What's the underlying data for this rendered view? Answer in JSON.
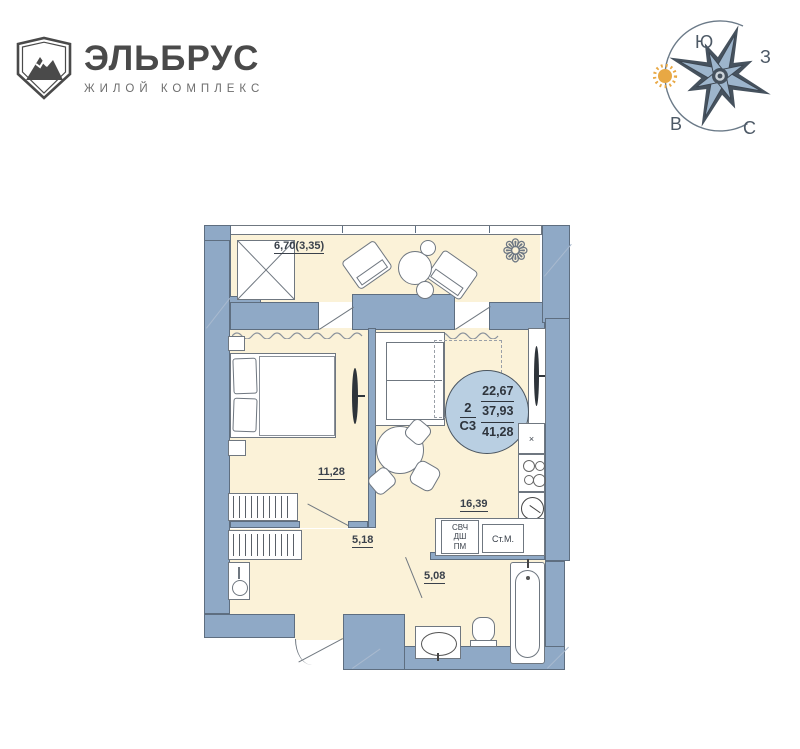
{
  "logo": {
    "name": "ЭЛЬБРУС",
    "tagline": "ЖИЛОЙ КОМПЛЕКС"
  },
  "compass": {
    "south": "Ю",
    "west": "З",
    "east": "В",
    "north": "С"
  },
  "apartment": {
    "badge": {
      "rooms": "2",
      "layout": "С3",
      "living_area": "22,67",
      "floor_area": "37,93",
      "total_area": "41,28"
    },
    "areas": {
      "balcony": "6,70(3,35)",
      "bedroom": "11,28",
      "kitchen_living": "16,39",
      "hallway": "5,18",
      "bathroom": "5,08"
    },
    "appliances": [
      "СВЧ",
      "ДШ",
      "ПМ"
    ],
    "washing_machine": "Ст.М.",
    "cabinet_mark": "×"
  },
  "colors": {
    "wall": "#8fa9c6",
    "wallline": "#5e6e80",
    "floor": "#fbf2d8",
    "badge": "#b9cfe2",
    "ink": "#3a414b",
    "logoink": "#4a4a4a",
    "sun": "#e8a844",
    "star": "#9db5cc",
    "stardark": "#46525e"
  }
}
